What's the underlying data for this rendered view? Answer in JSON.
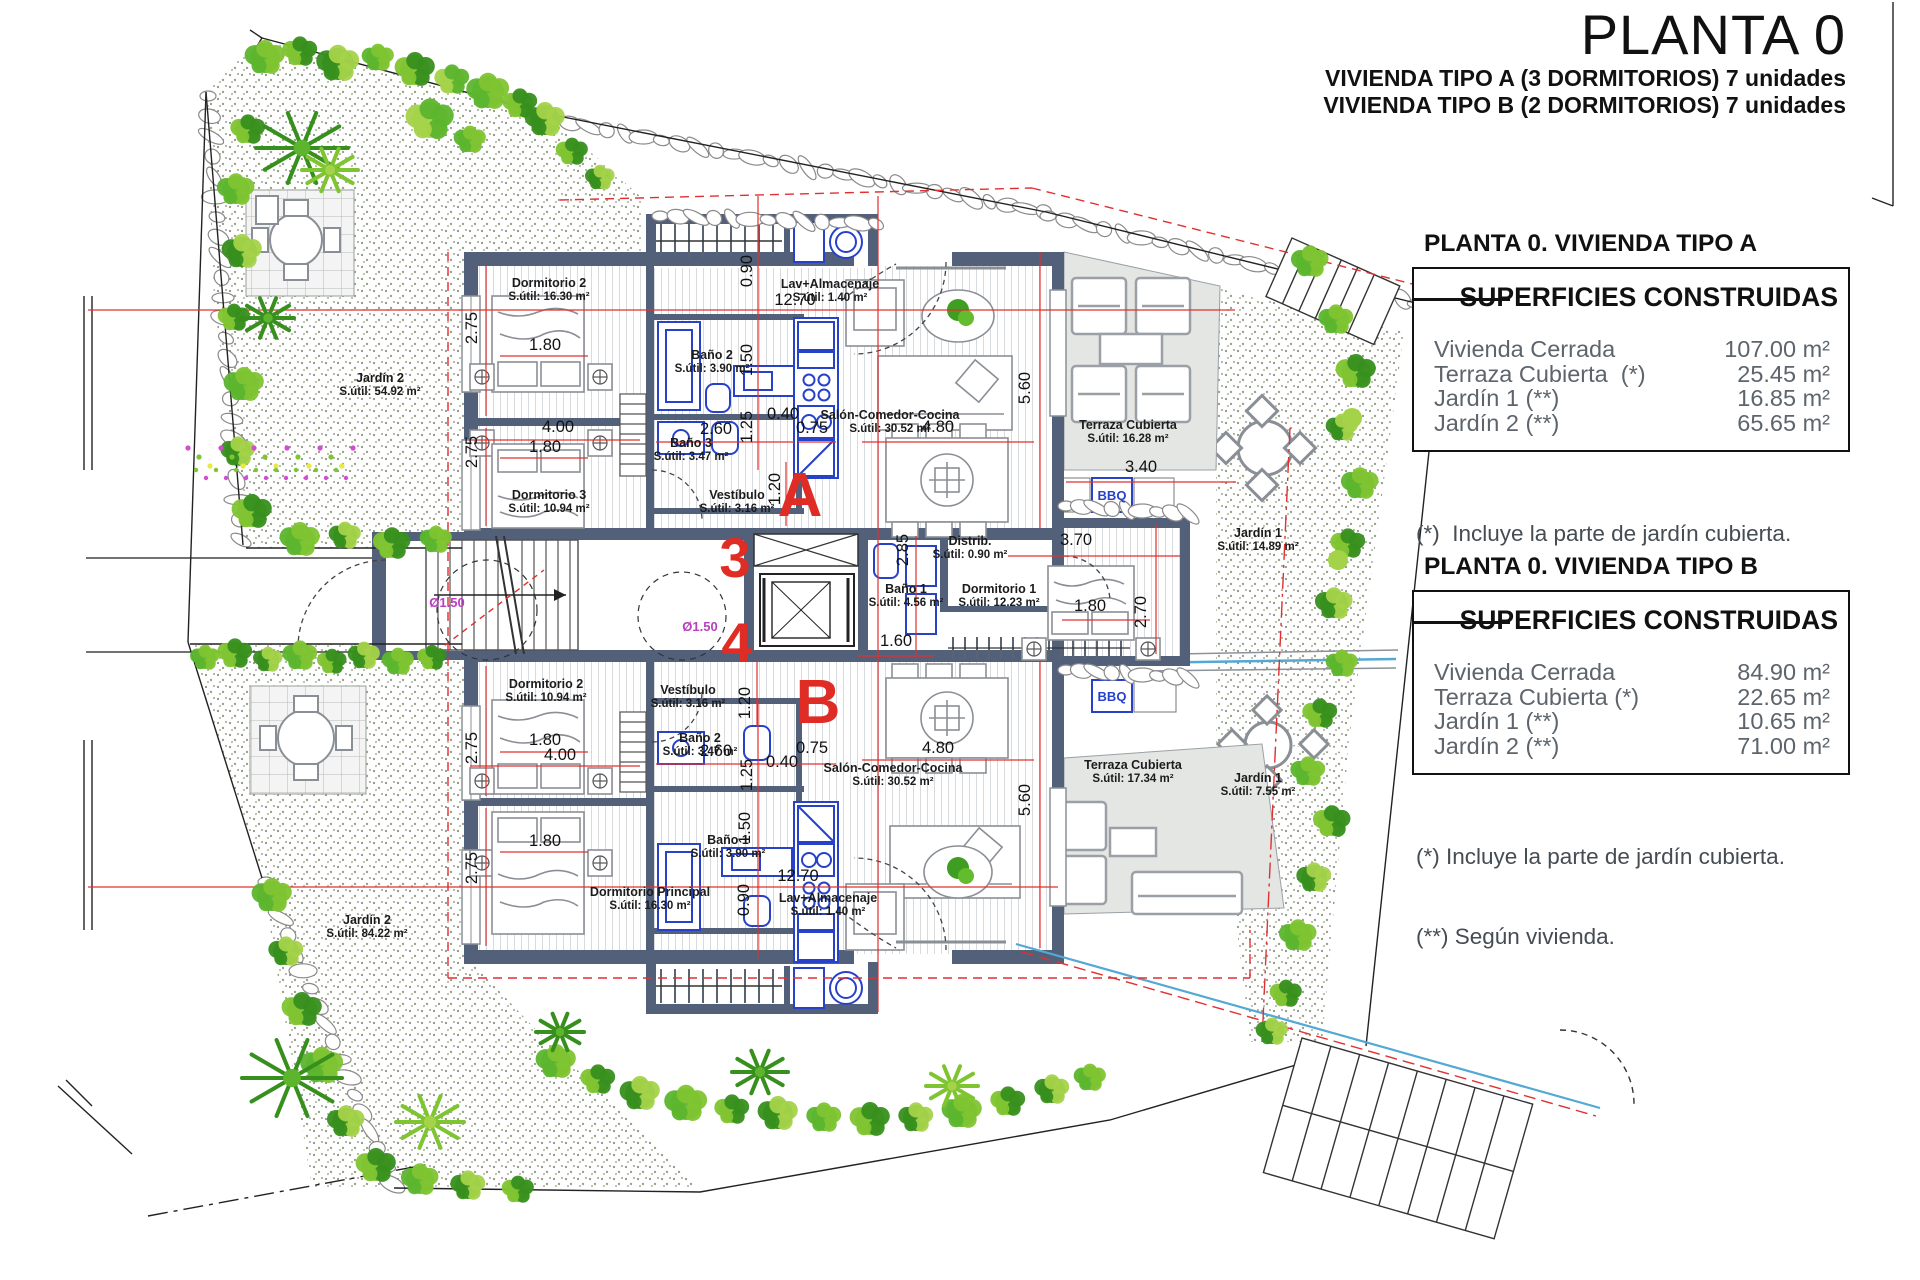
{
  "header": {
    "title": "PLANTA 0",
    "subtitle_a": "VIVIENDA TIPO A (3 DORMITORIOS) 7 unidades",
    "subtitle_b": "VIVIENDA TIPO B (2 DORMITORIOS) 7 unidades"
  },
  "panel_a": {
    "heading": "PLANTA 0. VIVIENDA TIPO A",
    "table_title": "SUPERFICIES CONSTRUIDAS",
    "rows": [
      {
        "label": "Vivienda Cerrada",
        "value": "107.00 m²"
      },
      {
        "label": "Terraza Cubierta  (*)",
        "value": "25.45 m²"
      },
      {
        "label": "Jardín 1 (**)",
        "value": "16.85 m²"
      },
      {
        "label": "Jardín 2 (**)",
        "value": "65.65 m²"
      }
    ],
    "notes": [
      "(*)  Incluye la parte de jardín cubierta.",
      "(**) Según vivienda."
    ]
  },
  "panel_b": {
    "heading": "PLANTA 0. VIVIENDA TIPO B",
    "table_title": "SUPERFICIES CONSTRUIDAS",
    "rows": [
      {
        "label": "Vivienda Cerrada",
        "value": "84.90 m²"
      },
      {
        "label": "Terraza Cubierta (*)",
        "value": "22.65 m²"
      },
      {
        "label": "Jardín 1 (**)",
        "value": "10.65 m²"
      },
      {
        "label": "Jardín 2 (**)",
        "value": "71.00 m²"
      }
    ],
    "notes": [
      "(*) Incluye la parte de jardín cubierta.",
      "(**) Según vivienda."
    ]
  },
  "plan": {
    "bbq_label": "BBQ",
    "bbq_positions": [
      {
        "x": 1112,
        "y": 500
      },
      {
        "x": 1112,
        "y": 701
      }
    ],
    "circles": [
      {
        "label": "Ø1.50",
        "x": 447,
        "y": 607
      },
      {
        "label": "Ø1.50",
        "x": 700,
        "y": 631
      }
    ],
    "letters": [
      {
        "t": "A",
        "x": 800,
        "y": 516,
        "big": true
      },
      {
        "t": "3",
        "x": 735,
        "y": 577
      },
      {
        "t": "4",
        "x": 737,
        "y": 662
      },
      {
        "t": "B",
        "x": 818,
        "y": 723,
        "big": true
      }
    ],
    "rooms": [
      {
        "n": "Dormitorio 2",
        "a": "S.útil: 16.30 m²",
        "x": 549,
        "y": 287
      },
      {
        "n": "Baño 2",
        "a": "S.útil: 3.90 m²",
        "x": 712,
        "y": 359
      },
      {
        "n": "Baño 3",
        "a": "S.útil: 3.47 m²",
        "x": 691,
        "y": 447
      },
      {
        "n": "Dormitorio 3",
        "a": "S.útil: 10.94 m²",
        "x": 549,
        "y": 499
      },
      {
        "n": "Lav+Almacenaje",
        "a": "S.útil: 1.40 m²",
        "x": 830,
        "y": 288
      },
      {
        "n": "Vestíbulo",
        "a": "S.útil: 3.16 m²",
        "x": 737,
        "y": 499
      },
      {
        "n": "Salón-Comedor-Cocina",
        "a": "S.útil: 30.52 m²",
        "x": 890,
        "y": 419
      },
      {
        "n": "Terraza Cubierta",
        "a": "S.útil: 16.28 m²",
        "x": 1128,
        "y": 429
      },
      {
        "n": "Distrib.",
        "a": "S.útil: 0.90 m²",
        "x": 970,
        "y": 545
      },
      {
        "n": "Baño 1",
        "a": "S.útil: 4.56 m²",
        "x": 906,
        "y": 593
      },
      {
        "n": "Dormitorio 1",
        "a": "S.útil: 12.23 m²",
        "x": 999,
        "y": 593
      },
      {
        "n": "Jardín 1",
        "a": "S.útil: 14.89 m²",
        "x": 1258,
        "y": 537
      },
      {
        "n": "Jardín 2",
        "a": "S.útil: 54.92 m²",
        "x": 380,
        "y": 382
      },
      {
        "n": "Dormitorio 2",
        "a": "S.útil: 10.94 m²",
        "x": 546,
        "y": 688
      },
      {
        "n": "Vestíbulo",
        "a": "S.útil: 3.16 m²",
        "x": 688,
        "y": 694
      },
      {
        "n": "Baño 2",
        "a": "S.útil: 3.47 m²",
        "x": 700,
        "y": 742
      },
      {
        "n": "Baño 1",
        "a": "S.útil: 3.90 m²",
        "x": 728,
        "y": 844
      },
      {
        "n": "Dormitorio Principal",
        "a": "S.útil: 16.30 m²",
        "x": 650,
        "y": 896
      },
      {
        "n": "Lav+Almacenaje",
        "a": "S.útil: 1.40 m²",
        "x": 828,
        "y": 902
      },
      {
        "n": "Salón-Comedor-Cocina",
        "a": "S.útil: 30.52 m²",
        "x": 893,
        "y": 772
      },
      {
        "n": "Terraza Cubierta",
        "a": "S.útil: 17.34 m²",
        "x": 1133,
        "y": 769
      },
      {
        "n": "Jardín 1",
        "a": "S.útil: 7.55 m²",
        "x": 1258,
        "y": 782
      },
      {
        "n": "Jardín 2",
        "a": "S.útil: 84.22 m²",
        "x": 367,
        "y": 924
      }
    ],
    "dims": [
      {
        "t": "12.70",
        "x": 795,
        "y": 305
      },
      {
        "t": "0.90",
        "x": 752,
        "y": 271,
        "r": 1
      },
      {
        "t": "2.75",
        "x": 477,
        "y": 328,
        "r": 1
      },
      {
        "t": "1.80",
        "x": 545,
        "y": 350
      },
      {
        "t": "4.00",
        "x": 558,
        "y": 432
      },
      {
        "t": "1.80",
        "x": 545,
        "y": 452
      },
      {
        "t": "2.75",
        "x": 477,
        "y": 452,
        "r": 1
      },
      {
        "t": "1.50",
        "x": 752,
        "y": 360,
        "r": 1
      },
      {
        "t": "1.25",
        "x": 752,
        "y": 427,
        "r": 1
      },
      {
        "t": "2.60",
        "x": 716,
        "y": 434
      },
      {
        "t": "0.40",
        "x": 783,
        "y": 419
      },
      {
        "t": "0.75",
        "x": 812,
        "y": 433
      },
      {
        "t": "1.20",
        "x": 780,
        "y": 489,
        "r": 1
      },
      {
        "t": "4.80",
        "x": 938,
        "y": 432
      },
      {
        "t": "5.60",
        "x": 1030,
        "y": 388,
        "r": 1
      },
      {
        "t": "3.40",
        "x": 1141,
        "y": 472
      },
      {
        "t": "2.85",
        "x": 908,
        "y": 550,
        "r": 1
      },
      {
        "t": "1.60",
        "x": 896,
        "y": 646
      },
      {
        "t": "3.70",
        "x": 1076,
        "y": 545
      },
      {
        "t": "1.80",
        "x": 1090,
        "y": 611
      },
      {
        "t": "2.70",
        "x": 1146,
        "y": 612,
        "r": 1
      },
      {
        "t": "1.20",
        "x": 750,
        "y": 703,
        "r": 1
      },
      {
        "t": "2.60",
        "x": 716,
        "y": 756
      },
      {
        "t": "0.40",
        "x": 782,
        "y": 767
      },
      {
        "t": "0.75",
        "x": 812,
        "y": 753
      },
      {
        "t": "1.25",
        "x": 752,
        "y": 775,
        "r": 1
      },
      {
        "t": "1.50",
        "x": 750,
        "y": 828,
        "r": 1
      },
      {
        "t": "1.80",
        "x": 545,
        "y": 745
      },
      {
        "t": "4.00",
        "x": 560,
        "y": 760
      },
      {
        "t": "2.75",
        "x": 477,
        "y": 748,
        "r": 1
      },
      {
        "t": "1.80",
        "x": 545,
        "y": 846
      },
      {
        "t": "2.75",
        "x": 477,
        "y": 868,
        "r": 1
      },
      {
        "t": "12.70",
        "x": 798,
        "y": 881
      },
      {
        "t": "0.90",
        "x": 749,
        "y": 900,
        "r": 1
      },
      {
        "t": "4.80",
        "x": 938,
        "y": 753
      },
      {
        "t": "5.60",
        "x": 1030,
        "y": 800,
        "r": 1
      }
    ]
  }
}
